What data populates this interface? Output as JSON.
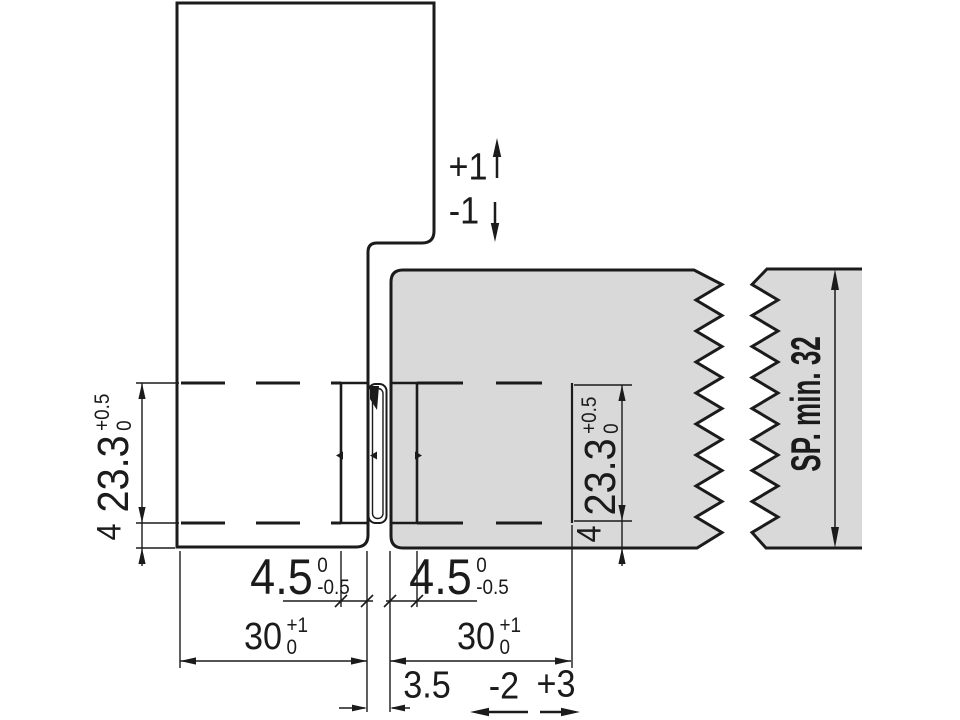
{
  "diagram": {
    "colors": {
      "panel_fill": "#d9d9d9",
      "line": "#1b1b1b"
    },
    "dimensions": {
      "vertical_play_up": "+1",
      "vertical_play_down": "-1",
      "left_groove_height": {
        "value": "23.3",
        "tol_upper": "+0.5",
        "tol_lower": "0"
      },
      "left_bottom_edge": "4",
      "right_groove_height": {
        "value": "23.3",
        "tol_upper": "+0.5",
        "tol_lower": "0"
      },
      "right_bottom_edge": "4",
      "left_groove_depth": {
        "value": "4.5",
        "tol_upper": "0",
        "tol_lower": "-0.5"
      },
      "right_groove_depth": {
        "value": "4.5",
        "tol_upper": "0",
        "tol_lower": "-0.5"
      },
      "left_panel_width": {
        "value": "30",
        "tol_upper": "+1",
        "tol_lower": "0"
      },
      "right_panel_width": {
        "value": "30",
        "tol_upper": "+1",
        "tol_lower": "0"
      },
      "panel_gap": "3.5",
      "horizontal_play_left": "-2",
      "horizontal_play_right": "+3",
      "min_thickness": "SP. min. 32"
    }
  }
}
